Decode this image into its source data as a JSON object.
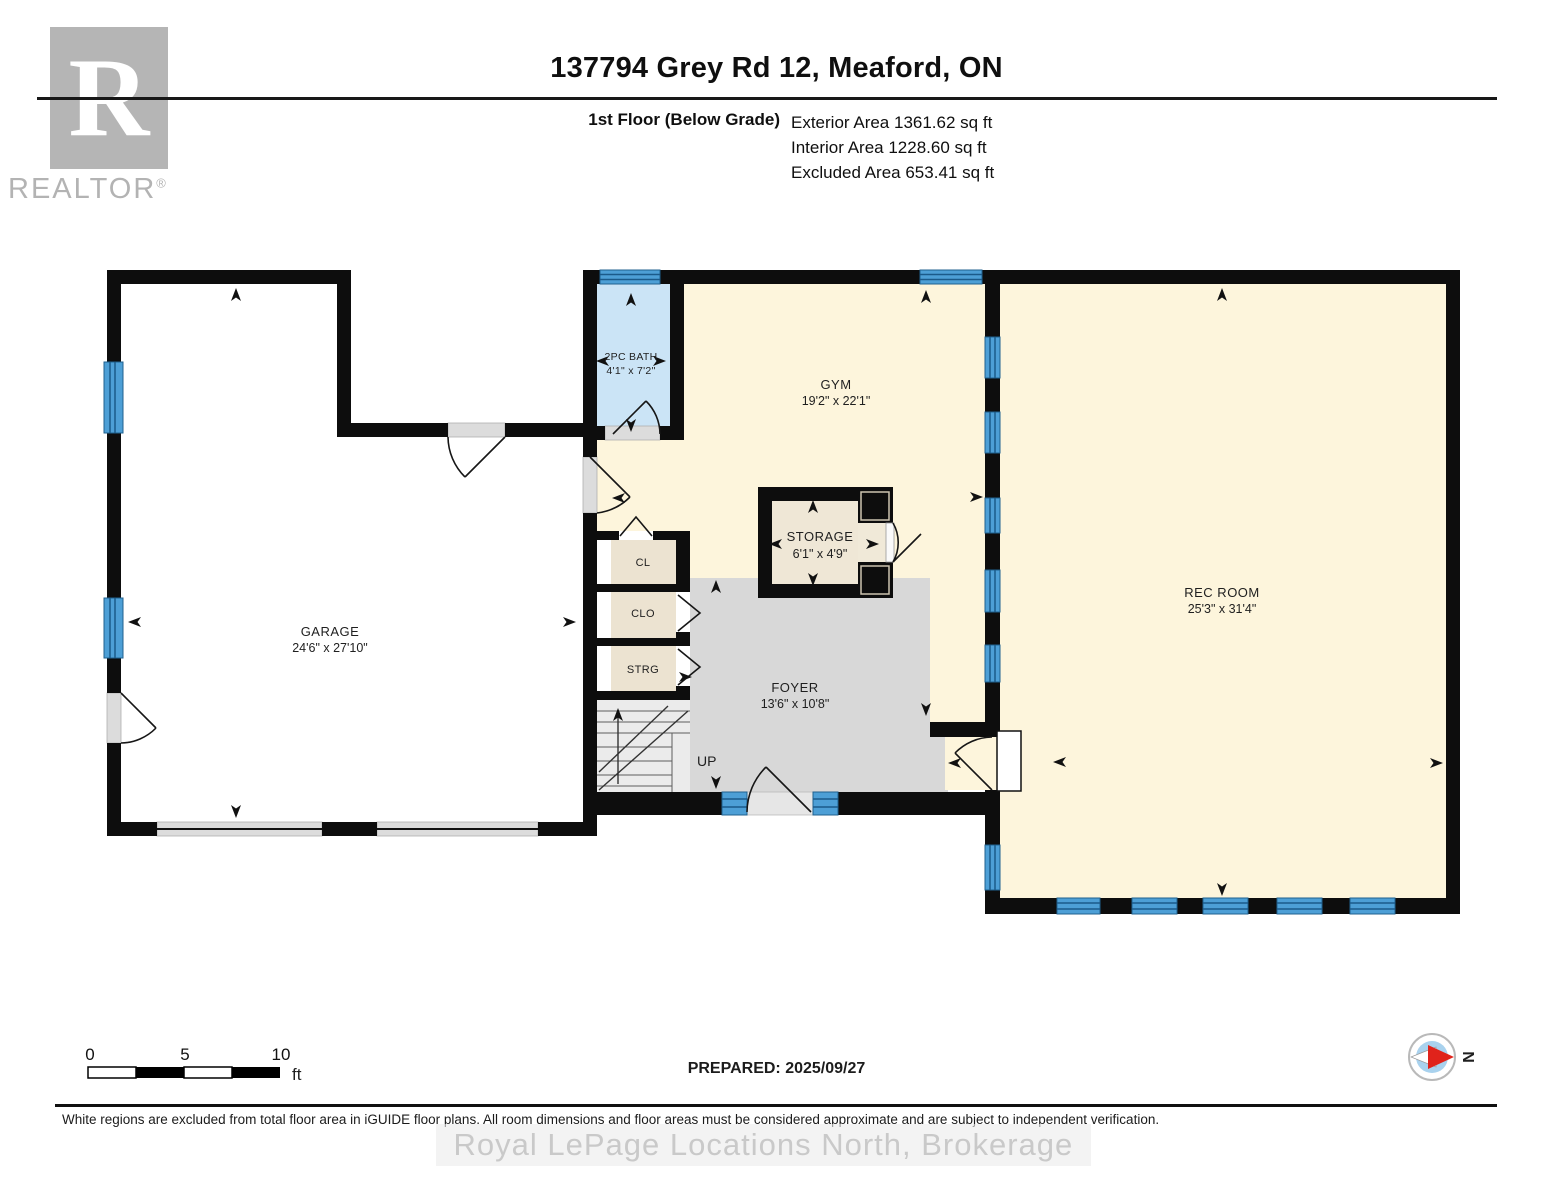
{
  "header": {
    "logo_letter": "R",
    "logo_text": "REALTOR",
    "logo_reg": "®",
    "title": "137794 Grey Rd 12, Meaford, ON",
    "floor_label": "1st Floor (Below Grade)",
    "areas": {
      "exterior": "Exterior Area 1361.62 sq ft",
      "interior": "Interior Area 1228.60 sq ft",
      "excluded": "Excluded Area 653.41 sq ft"
    }
  },
  "plan": {
    "rooms": {
      "garage": {
        "name": "GARAGE",
        "dims": "24'6\" x 27'10\""
      },
      "bath": {
        "name": "2PC BATH",
        "dims": "4'1\" x 7'2\""
      },
      "gym": {
        "name": "GYM",
        "dims": "19'2\" x 22'1\""
      },
      "storage": {
        "name": "STORAGE",
        "dims": "6'1\" x 4'9\""
      },
      "rec_room": {
        "name": "REC ROOM",
        "dims": "25'3\" x 31'4\""
      },
      "foyer": {
        "name": "FOYER",
        "dims": "13'6\" x 10'8\""
      },
      "cl": {
        "name": "CL"
      },
      "clo": {
        "name": "CLO"
      },
      "strg": {
        "name": "STRG"
      },
      "stairs_label": "UP"
    },
    "colors": {
      "wall": "#0d0d0d",
      "interior_cream": "#fdf5dc",
      "bath_blue": "#cbe4f6",
      "window_blue": "#4d9fd6",
      "foyer_gray": "#d8d8d8",
      "closet_beige": "#ece3d1",
      "excluded_white": "#ffffff"
    }
  },
  "footer": {
    "scale": {
      "t0": "0",
      "t5": "5",
      "t10": "10",
      "unit": "ft"
    },
    "prepared": "PREPARED: 2025/09/27",
    "compass_label": "N",
    "disclaimer": "White regions are excluded from total floor area in iGUIDE floor plans. All room dimensions and floor areas must be considered approximate and are subject to independent verification.",
    "watermark": "Royal LePage Locations North, Brokerage"
  }
}
